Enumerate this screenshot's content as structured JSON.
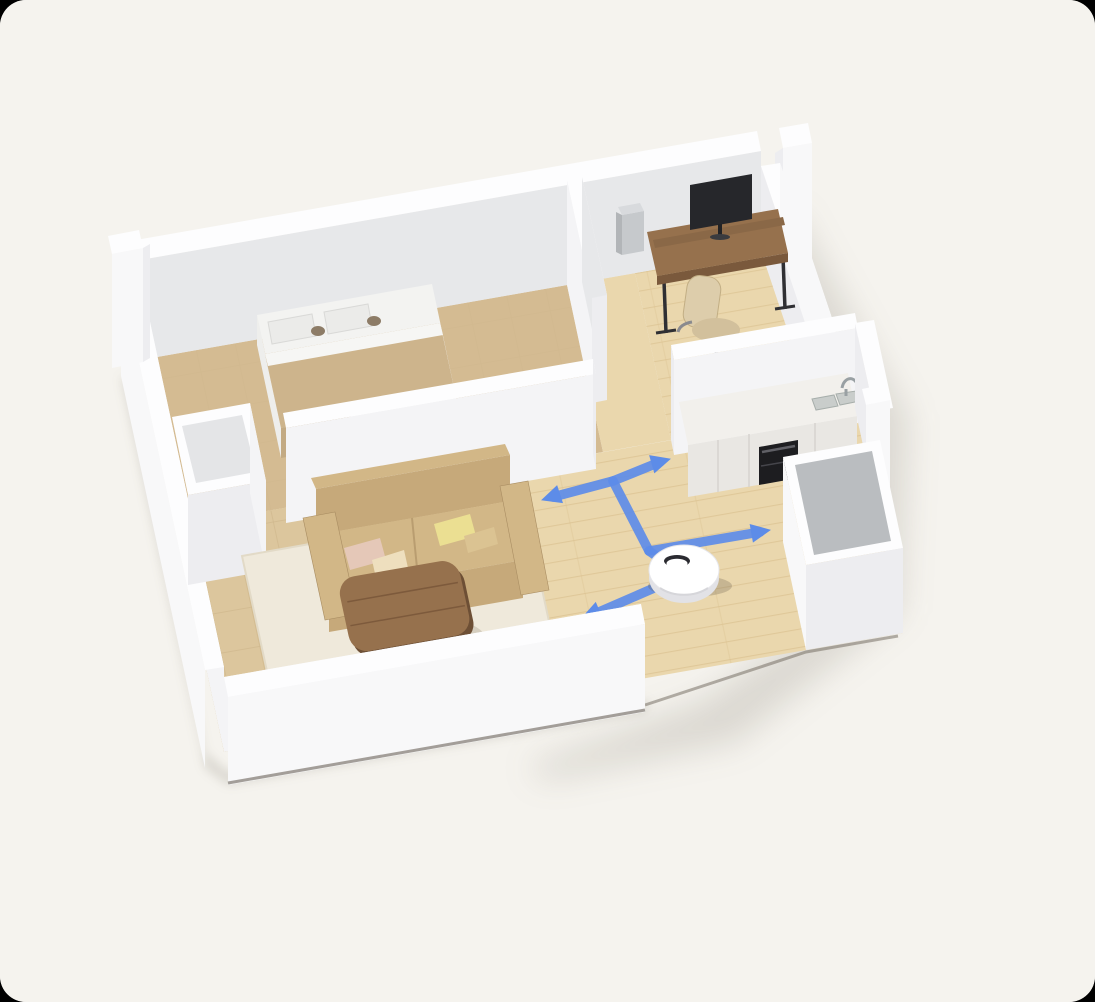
{
  "scene": {
    "description": "Isometric 3D cutaway render of a one-bedroom apartment with a robot vacuum following a blue navigation path with arrows through the hallway between bedroom, home office, kitchen and living room",
    "rooms": [
      {
        "name": "bedroom",
        "furniture": [
          "double-bed",
          "white-pillows",
          "beige-blanket",
          "wardrobe-nook"
        ]
      },
      {
        "name": "home-office",
        "furniture": [
          "wooden-desk",
          "curved-monitor",
          "desk-shelf-riser",
          "pc-tower",
          "beige-task-chair"
        ]
      },
      {
        "name": "kitchen",
        "furniture": [
          "cabinet-counter",
          "built-in-oven",
          "double-sink",
          "faucet",
          "island-counter"
        ]
      },
      {
        "name": "living-room",
        "furniture": [
          "beige-leather-sofa",
          "throw-pillows",
          "cream-area-rug",
          "round-wood-coffee-table"
        ]
      },
      {
        "name": "hallway",
        "furniture": [
          "robot-vacuum"
        ]
      }
    ],
    "robot": {
      "name": "robot-vacuum",
      "position": {
        "x": 684,
        "y": 572
      }
    }
  },
  "robot_path": {
    "color": "#5d8ce8",
    "width": 9.5,
    "segments": [
      {
        "points": "613,481 553,497"
      },
      {
        "points": "613,481 660,462"
      },
      {
        "points": "613,481 649,551"
      },
      {
        "points": "649,551 760,532"
      },
      {
        "points": "649,551 684,575 592,615"
      }
    ],
    "arrows": [
      {
        "x": 542,
        "y": 500,
        "angle": 162
      },
      {
        "x": 670,
        "y": 459,
        "angle": -16
      },
      {
        "x": 770,
        "y": 530,
        "angle": -10
      },
      {
        "x": 582,
        "y": 618,
        "angle": 157
      }
    ]
  },
  "colors": {
    "bg": "#f5f3ee",
    "corner": "#000000",
    "wallTop": "#fdfdfe",
    "wallLight": "#f4f4f6",
    "wallMid": "#ededf0",
    "wallShade": "#e7e8ea",
    "wallOuter": "#f8f8f9",
    "recess": "#e4e5e7",
    "floorWood": "#ead7ad",
    "floorWoodLine": "#d9bf8e",
    "floorTile": "#dcc69d",
    "floorTileLine": "#ccb488",
    "floorBedroom": "#d4bb92",
    "rug": "#efe9db",
    "rugEdge": "#e2dac7",
    "sofa": "#c6a97a",
    "sofaDark": "#a98d62",
    "sofaLight": "#d2b787",
    "pillowPink": "#e5c8b8",
    "pillowCream": "#eedfbe",
    "pillowYellow": "#ebdf92",
    "pillowTan": "#dbc392",
    "wood": "#96714d",
    "woodDark": "#7a593c",
    "bedSheet": "#f3f3f1",
    "bedShade": "#e6e6e4",
    "blanket": "#cdb48c",
    "blanketFront": "#c3aa83",
    "pillow": "#ebebe9",
    "monitor": "#26272b",
    "ovenBlack": "#1d1d20",
    "counter": "#e9e7e3",
    "counterTop": "#f2f0ec",
    "counterSeam": "#d6d3cf",
    "steel": "#c9cdcb",
    "steelDark": "#99a0a3",
    "chair": "#ddcdab",
    "chairDark": "#c2ae84",
    "islandTop": "#babdc0",
    "robotBody": "#ffffff",
    "robotSide": "#e2e2e6",
    "robotDark": "#2b2b31",
    "shadow": "rgba(96,88,70,0.17)",
    "slab": "#5f564b"
  }
}
